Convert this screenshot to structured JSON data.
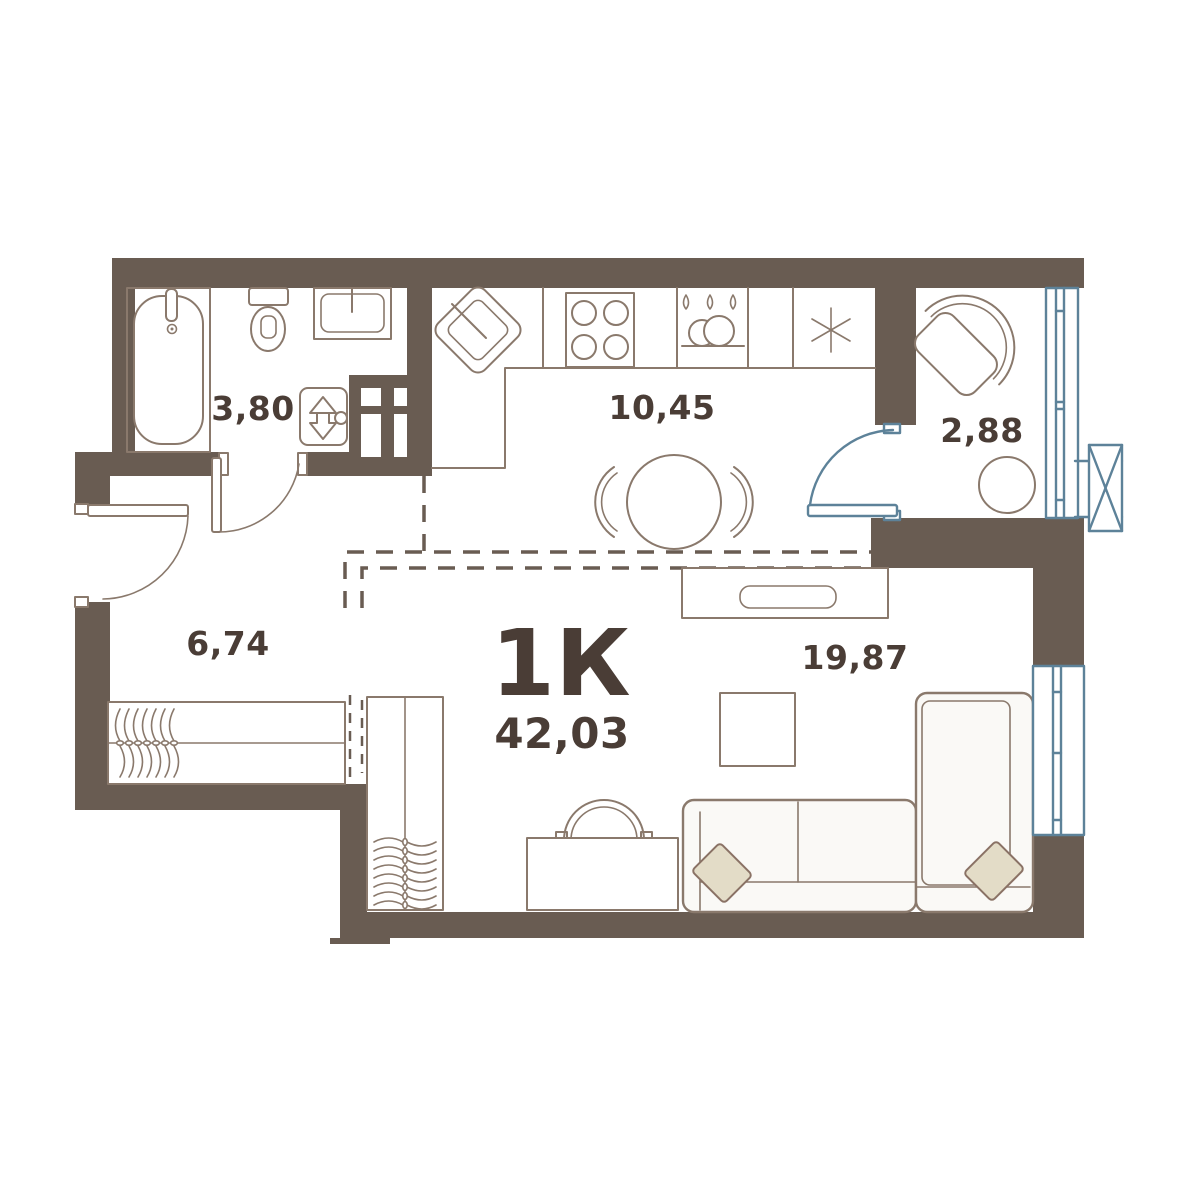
{
  "plan": {
    "title": "1К",
    "total_area": "42,03",
    "rooms": {
      "bathroom_area": "3,80",
      "kitchen_area": "10,45",
      "balcony_area": "2,88",
      "hallway_area": "6,74",
      "living_area": "19,87"
    },
    "colors": {
      "wall": "#695c52",
      "furniture_line": "#8a796c",
      "text": "#4a3d36",
      "glazing": "#5d8299",
      "pillow": "#e3dcc7"
    }
  }
}
